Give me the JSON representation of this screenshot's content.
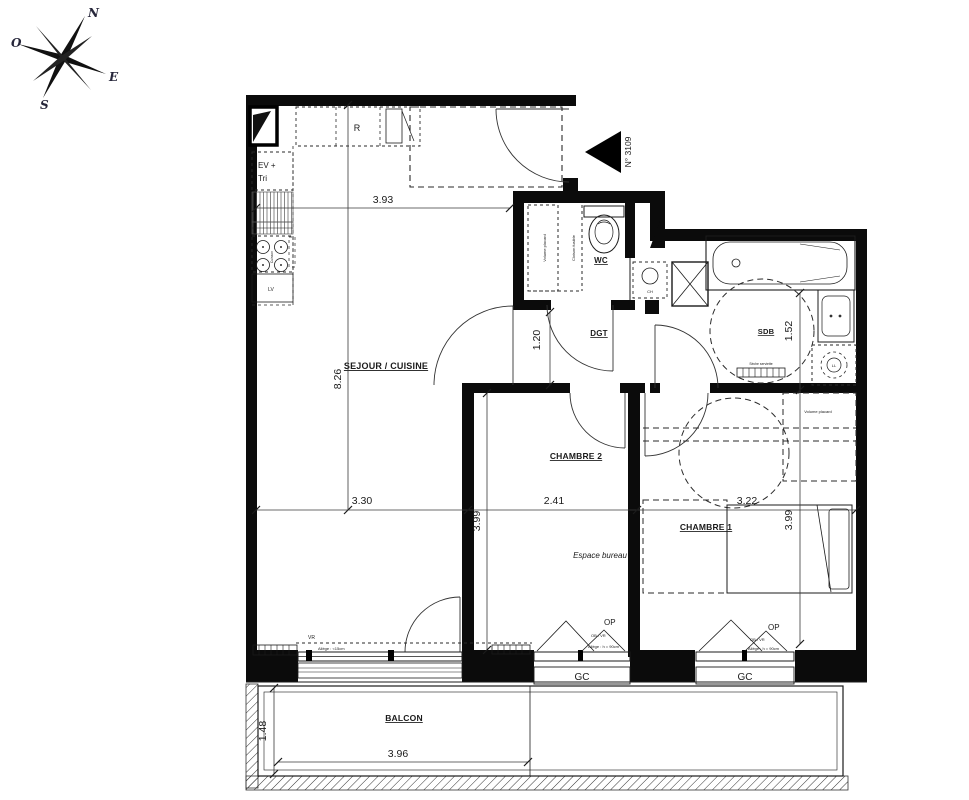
{
  "compass": {
    "north": "N",
    "west": "O",
    "east": "E",
    "south": "S"
  },
  "entrance": {
    "unit_number": "N° 3109"
  },
  "rooms": {
    "sejour": "SEJOUR / CUISINE",
    "wc": "WC",
    "dgt": "DGT",
    "sdb": "SDB",
    "chambre2": "CHAMBRE 2",
    "chambre1": "CHAMBRE 1",
    "espace_bureau": "Espace bureau",
    "balcon": "BALCON"
  },
  "kitchen": {
    "fridge": "R",
    "sink_line1": "EV +",
    "sink_line2": "Tri",
    "hob": "Cuisson",
    "dishwasher": "LV"
  },
  "equipment": {
    "water_heater": "CH",
    "washing_machine": "LL",
    "towel_dryer": "Sèche serviette"
  },
  "closets": {
    "wc_volume": "Volume placard",
    "wc_partition": "Cloison fusible",
    "ch1_volume": "Volume placard"
  },
  "windows": {
    "sejour_shutter": "VR",
    "sejour_sill": "Allège : <15cm",
    "ch2_opening": "OP",
    "ch2_type": "OB / VR",
    "ch2_sill": "Allège : h = 90cm",
    "ch1_opening": "OP",
    "ch1_type": "OB / VR",
    "ch1_sill": "Allège : h = 90cm",
    "guardrail_ch2": "GC",
    "guardrail_ch1": "GC"
  },
  "dimensions": {
    "entry_width": "3.93",
    "sejour_height": "8.26",
    "sejour_width": "3.30",
    "chambre2_width": "2.41",
    "chambre1_width": "3.22",
    "chambre2_height": "3.99",
    "chambre1_height": "3.99",
    "dgt_width": "1.20",
    "sdb_width": "1.52",
    "balcon_height": "1.48",
    "balcon_width": "3.96"
  }
}
